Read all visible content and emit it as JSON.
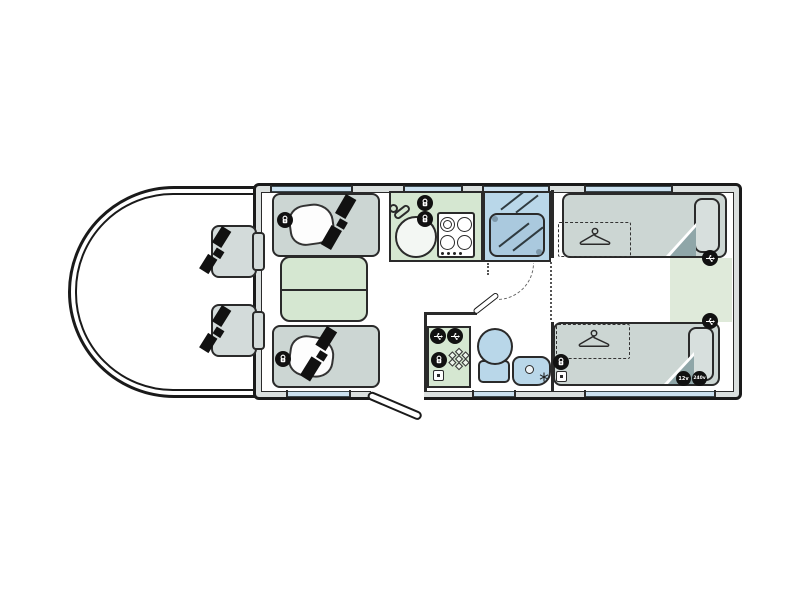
{
  "diagram": {
    "name": "motorhome-floorplan",
    "badges": {
      "v12": "12v",
      "v240": "240v"
    },
    "rooms": [
      "cab",
      "lounge",
      "kitchen",
      "shower-room",
      "washroom",
      "twin-bedroom"
    ],
    "furniture": [
      "cab-seat-driver",
      "cab-seat-passenger",
      "sofa-top",
      "sofa-bottom",
      "table",
      "sink",
      "hob",
      "shower-cubicle",
      "toilet",
      "basin",
      "fridge-cabinet",
      "single-bed-top",
      "single-bed-bottom",
      "underbed-wardrobe-top",
      "underbed-wardrobe-bottom"
    ],
    "icons": [
      "230v-socket",
      "usb-point",
      "12v-socket",
      "tv-point",
      "heater-vent-snowflake",
      "seatbelt",
      "coat-hanger",
      "tap"
    ],
    "colors": {
      "outline": "#1a1a1a",
      "wall_fill": "#dadfde",
      "window_blue": "#cbe1f0",
      "furniture_grey": "#ccd6d3",
      "surface_green": "#d5e7d1",
      "fixture_blue": "#b9d7e9",
      "rear_floor_green": "#dfeada",
      "fold_teal": "#8fa6a8",
      "floor": "#ffffff"
    }
  }
}
